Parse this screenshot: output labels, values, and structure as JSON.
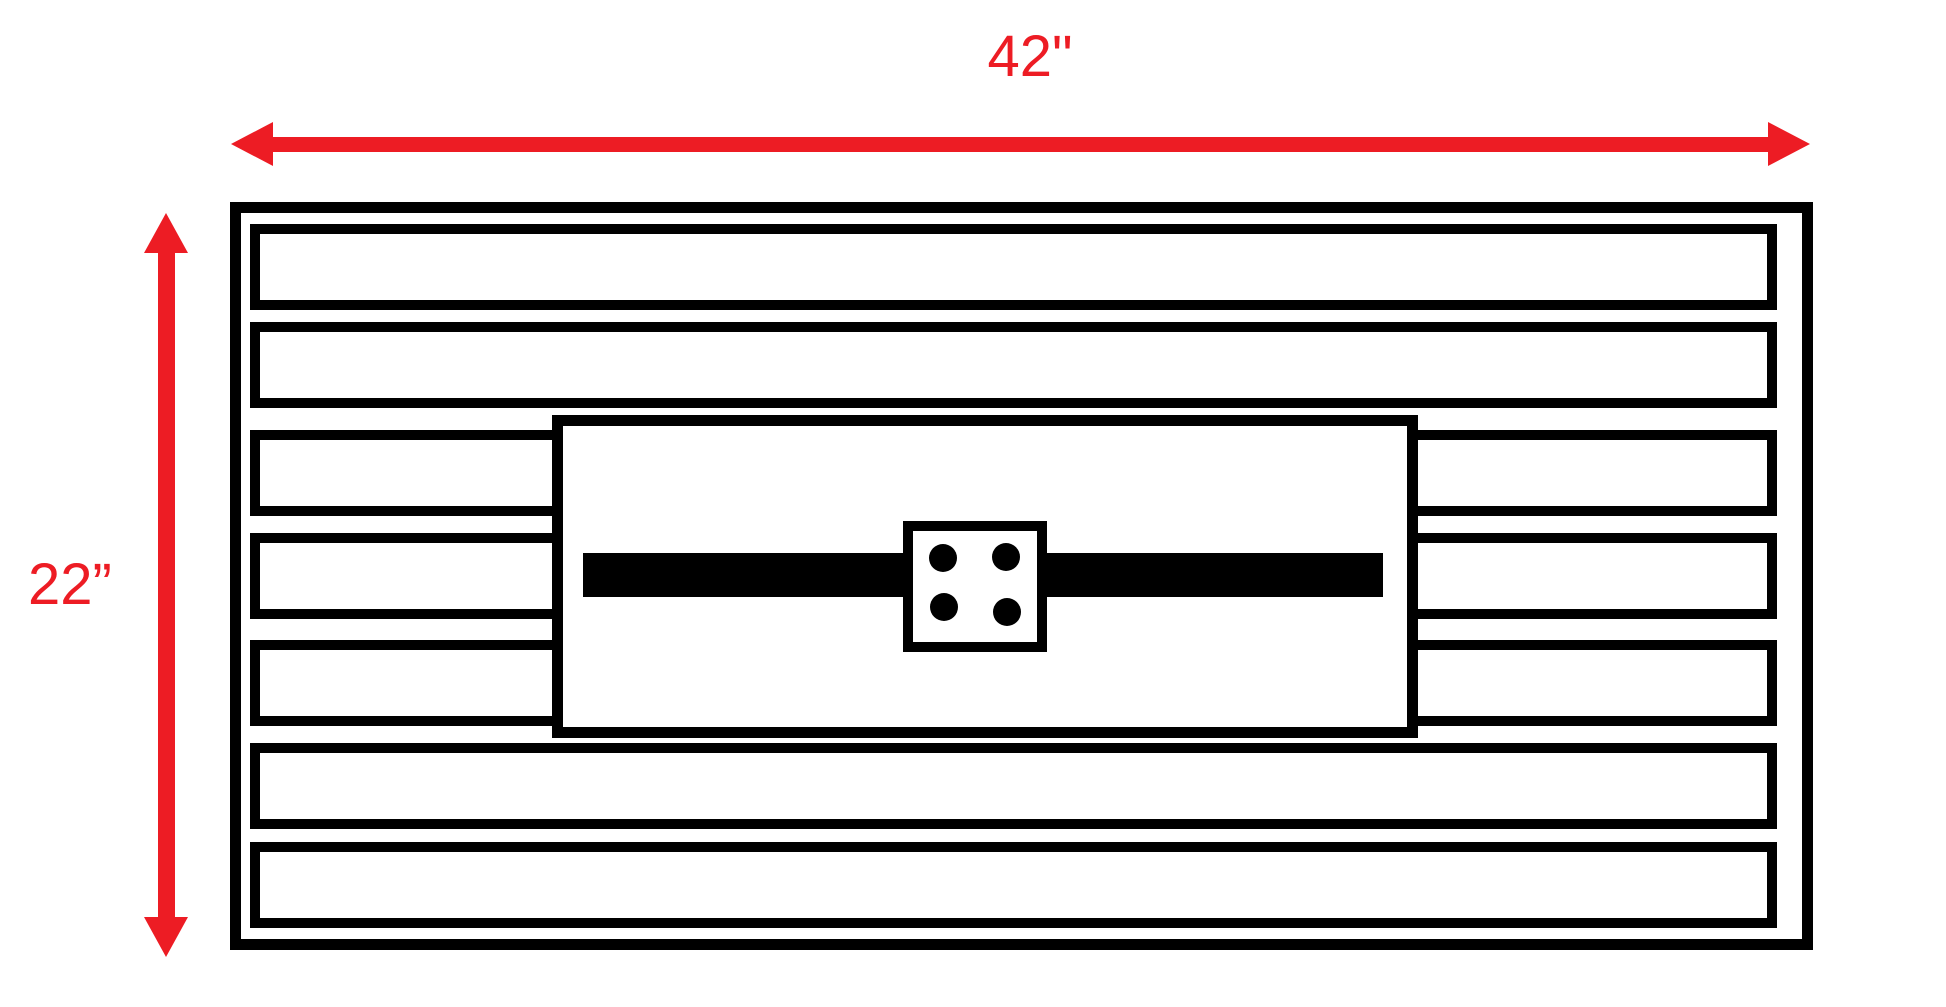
{
  "colors": {
    "annotation_red": "#ed1c24",
    "ink_black": "#000000",
    "background_white": "#ffffff"
  },
  "annotations": {
    "width_dimension": {
      "label": "42\""
    },
    "height_dimension": {
      "label": "22”"
    }
  },
  "panel": {
    "slat_rows": [
      {
        "type": "full"
      },
      {
        "type": "full"
      },
      {
        "type": "split"
      },
      {
        "type": "split"
      },
      {
        "type": "split"
      },
      {
        "type": "full"
      },
      {
        "type": "full"
      }
    ],
    "center_assembly": {
      "bolt_count": 4
    }
  }
}
